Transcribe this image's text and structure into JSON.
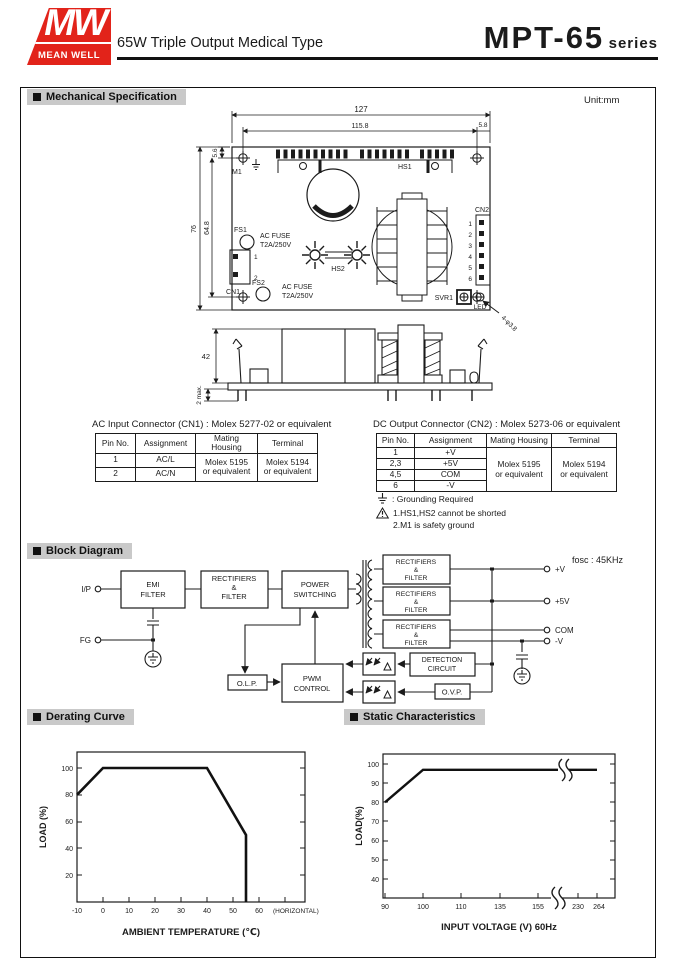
{
  "page": {
    "unit": "Unit:mm"
  },
  "header": {
    "logo_mw": "MW",
    "logo_name": "MEAN WELL",
    "subtitle": "65W Triple Output Medical Type",
    "series": "MPT-65",
    "series_suffix": "series"
  },
  "sections": {
    "mechanical": "Mechanical Specification",
    "block": "Block Diagram",
    "derating": "Derating Curve",
    "statics": "Static Characteristics"
  },
  "colors": {
    "logo_red": "#E2231A",
    "section_bg": "#C9C9C9",
    "ink": "#1B1B1B"
  },
  "mech": {
    "dims": {
      "w": "127",
      "inner_w": "115.8",
      "right": "5.8",
      "top": "5.6",
      "h": "76",
      "inner_h": "64.8",
      "side_h": "42",
      "pin": "2 max.",
      "holes": "4-φ3.8"
    },
    "labels": {
      "m1": "M1",
      "hs1": "HS1",
      "hs2": "HS2",
      "fs1": "FS1",
      "fs2": "FS2",
      "cn1": "CN1",
      "cn2": "CN2",
      "svr1": "SVR1",
      "led": "LED",
      "fuse1": "AC FUSE",
      "fuse2": "T2A/250V"
    },
    "cn1_pins": [
      "1",
      "2"
    ],
    "cn2_pins": [
      "1",
      "2",
      "3",
      "4",
      "5",
      "6"
    ]
  },
  "tables": {
    "cn1": {
      "title": "AC Input Connector (CN1) : Molex 5277-02  or equivalent",
      "headers": [
        "Pin No.",
        "Assignment",
        "Mating Housing",
        "Terminal"
      ],
      "rows": [
        [
          "1",
          "AC/L"
        ],
        [
          "2",
          "AC/N"
        ]
      ],
      "mating": [
        "Molex 5195",
        "or equivalent"
      ],
      "terminal": [
        "Molex 5194",
        "or equivalent"
      ]
    },
    "cn2": {
      "title": "DC Output Connector (CN2) : Molex 5273-06 or equivalent",
      "headers": [
        "Pin No.",
        "Assignment",
        "Mating Housing",
        "Terminal"
      ],
      "rows": [
        [
          "1",
          "+V"
        ],
        [
          "2,3",
          "+5V"
        ],
        [
          "4,5",
          "COM"
        ],
        [
          "6",
          "-V"
        ]
      ],
      "mating": [
        "Molex 5195",
        "or equivalent"
      ],
      "terminal": [
        "Molex 5194",
        "or equivalent"
      ]
    },
    "notes": {
      "grounding": ": Grounding Required",
      "note1": "1.HS1,HS2 cannot be shorted",
      "note2": "2.M1 is safety ground"
    }
  },
  "block": {
    "fosc": "fosc : 45KHz",
    "ip": "I/P",
    "fg": "FG",
    "emi": [
      "EMI",
      "FILTER"
    ],
    "rect": [
      "RECTIFIERS",
      "&",
      "FILTER"
    ],
    "power": [
      "POWER",
      "SWITCHING"
    ],
    "pwm": [
      "PWM",
      "CONTROL"
    ],
    "det": [
      "DETECTION",
      "CIRCUIT"
    ],
    "olp": "O.L.P.",
    "ovp": "O.V.P.",
    "outputs": [
      "+V",
      "+5V",
      "COM",
      "-V"
    ]
  },
  "chart_data": [
    {
      "type": "line",
      "title": "Derating Curve",
      "xlabel": "AMBIENT TEMPERATURE (℃)",
      "ylabel": "LOAD (%)",
      "x_ticks": [
        -10,
        0,
        10,
        20,
        30,
        40,
        50,
        60
      ],
      "x_suffix": "(HORIZONTAL)",
      "y_ticks": [
        20,
        40,
        60,
        80,
        100
      ],
      "xlim": [
        -10,
        70
      ],
      "ylim": [
        0,
        110
      ],
      "grid": false,
      "legend": null,
      "series": [
        {
          "name": "load-limit",
          "points": [
            [
              -10,
              80
            ],
            [
              0,
              100
            ],
            [
              40,
              100
            ],
            [
              55,
              50
            ],
            [
              55,
              0
            ]
          ]
        }
      ]
    },
    {
      "type": "line",
      "title": "Static Characteristics",
      "xlabel": "INPUT VOLTAGE (V) 60Hz",
      "ylabel": "LOAD(%)",
      "x_ticks": [
        90,
        100,
        110,
        135,
        155,
        230,
        264
      ],
      "y_ticks": [
        40,
        50,
        60,
        70,
        80,
        90,
        100
      ],
      "xlim": [
        90,
        264
      ],
      "ylim": [
        30,
        105
      ],
      "axis_break_between": [
        155,
        230
      ],
      "grid": false,
      "legend": null,
      "series": [
        {
          "name": "load",
          "points": [
            [
              90,
              80
            ],
            [
              100,
              97
            ],
            [
              264,
              97
            ]
          ]
        }
      ]
    }
  ]
}
